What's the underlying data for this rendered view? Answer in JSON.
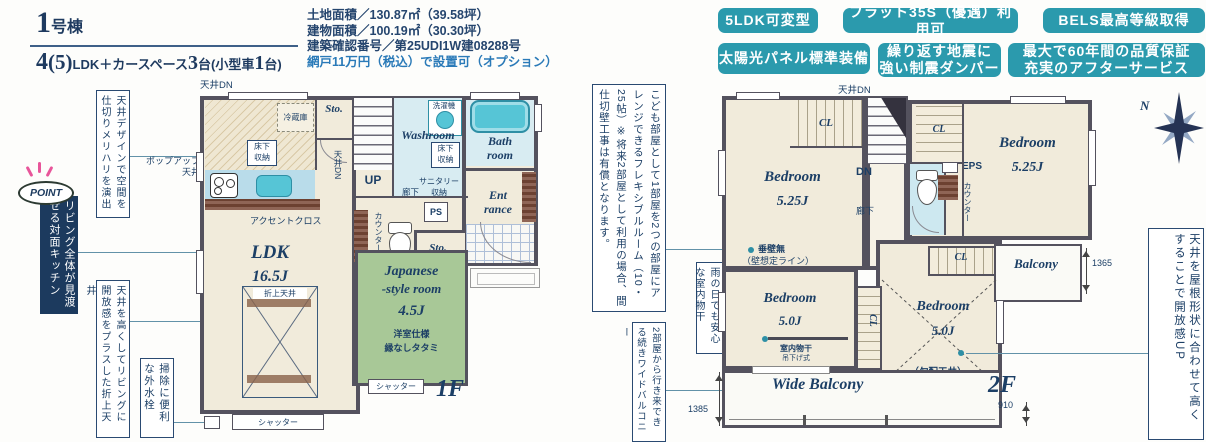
{
  "header": {
    "building_no_num": "1",
    "building_no_suffix": "号棟",
    "layout": {
      "n1": "4",
      "p1": "(5)",
      "t1": "LDK＋カースペース",
      "n2": "3",
      "t2": "台(小型車",
      "n3": "1",
      "t3": "台)"
    },
    "spec_line1": "土地面積／130.87㎡（39.58坪）",
    "spec_line2": "建物面積／100.19㎡（30.30坪）",
    "spec_line3": "建築確認番号／第25UDI1W建08288号",
    "spec_line4": "網戸11万円（税込）で設置可（オプション）",
    "badges": {
      "b1": "5LDK可変型",
      "b2": "フラット35S（優遇）利用可",
      "b3": "BELS最高等級取得",
      "b4": "太陽光パネル標準装備",
      "b5a": "繰り返す地震に",
      "b5b": "強い制震ダンパー",
      "b6a": "最大で60年間の品質保証",
      "b6b": "充実のアフターサービス"
    }
  },
  "callouts": {
    "ceiling_design": "天井デザインで空間を仕切りメリハリを演出",
    "point_label": "POINT",
    "point_text": "リビング全体が見渡せる対面キッチン",
    "popup_ceiling_1": "ポップアップ",
    "popup_ceiling_2": "天井",
    "raised_ceiling": "天井を高くしてリビングに開放感をプラスした折上天井",
    "outdoor_faucet": "掃除に便利な外水栓",
    "flexible_room": "こども部屋として1部屋を2つの部屋にアレンジできるフレキシブルルーム（10・25帖）※将来2部屋として利用の場合、間仕切壁工事は有償となります。",
    "indoor_drying": "雨の日でも安心な室内物干",
    "continuous_balcony": "2部屋から行き来できる続きワイドバルコニー",
    "sloped_open": "天井を屋根形状に合わせて高くすることで開放感UP"
  },
  "floor1": {
    "label": "1F",
    "ceiling_dn": "天井DN",
    "fridge": "冷蔵庫",
    "sto": "Sto.",
    "uf1": "床下",
    "uf2": "収納",
    "up": "UP",
    "washroom": "Washroom",
    "washer": "洗濯機",
    "sanitary1": "サニタリー",
    "sanitary2": "収納",
    "hallway": "廊下",
    "ps": "PS",
    "counter": "カウンター",
    "bath1": "Bath",
    "bath2": "room",
    "ent1": "Ent",
    "ent2": "rance",
    "accent": "アクセントクロス",
    "ldk": "LDK",
    "ldk_size": "16.5J",
    "oriage": "折上天井",
    "jp1": "Japanese",
    "jp2": "-style room",
    "jp_size": "4.5J",
    "jp_note1": "洋室仕様",
    "jp_note2": "縁なしタタミ",
    "shutter": "シャッター"
  },
  "floor2": {
    "label": "2F",
    "ceiling_dn": "天井DN",
    "bedroom": "Bedroom",
    "size_525": "5.25J",
    "size_50": "5.0J",
    "cl": "CL",
    "dn": "DN",
    "hallway": "廊下",
    "eps": "EPS",
    "counter": "カウンター",
    "balcony": "Balcony",
    "tarekabe": "垂壁無",
    "wall_line": "（壁想定ライン）",
    "drying1": "室内物干",
    "drying2": "吊下げ式",
    "sloped": "（勾配天井）",
    "wide_balcony": "Wide Balcony",
    "dim_balcony": "1365",
    "dim_wide": "1385",
    "dim_910": "910",
    "compass_n": "N"
  },
  "colors": {
    "badge_teal": "#2b9aad",
    "navy": "#1c3f66",
    "wall": "#54525e",
    "tatami": "#a8c897",
    "water": "#56c5d6"
  }
}
